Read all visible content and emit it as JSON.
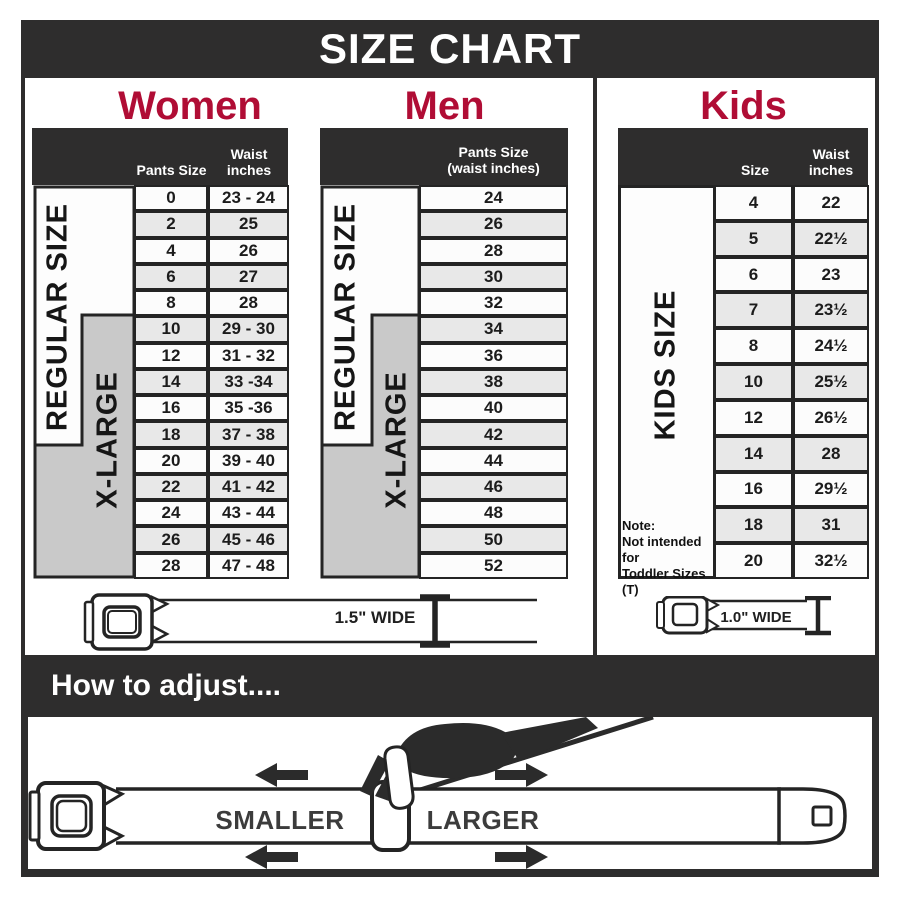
{
  "title": "SIZE CHART",
  "colors": {
    "dark": "#2e2d2d",
    "accent_red": "#b00d35",
    "xlarge_gray": "#c9c9c9",
    "row_alt_gray": "#e8e8e8"
  },
  "women": {
    "heading": "Women",
    "col1_header": "Pants Size",
    "col2_header": "Waist inches",
    "regular_label": "REGULAR SIZE",
    "xlarge_label": "X-LARGE",
    "belt_width_label": "1.5\" WIDE",
    "rows": [
      {
        "size": "0",
        "waist": "23 - 24"
      },
      {
        "size": "2",
        "waist": "25"
      },
      {
        "size": "4",
        "waist": "26"
      },
      {
        "size": "6",
        "waist": "27"
      },
      {
        "size": "8",
        "waist": "28"
      },
      {
        "size": "10",
        "waist": "29 - 30"
      },
      {
        "size": "12",
        "waist": "31 - 32"
      },
      {
        "size": "14",
        "waist": "33 -34"
      },
      {
        "size": "16",
        "waist": "35 -36"
      },
      {
        "size": "18",
        "waist": "37 - 38"
      },
      {
        "size": "20",
        "waist": "39 - 40"
      },
      {
        "size": "22",
        "waist": "41 - 42"
      },
      {
        "size": "24",
        "waist": "43 - 44"
      },
      {
        "size": "26",
        "waist": "45 - 46"
      },
      {
        "size": "28",
        "waist": "47 - 48"
      }
    ]
  },
  "men": {
    "heading": "Men",
    "col_header_line1": "Pants Size",
    "col_header_line2": "(waist inches)",
    "regular_label": "REGULAR SIZE",
    "xlarge_label": "X-LARGE",
    "rows": [
      "24",
      "26",
      "28",
      "30",
      "32",
      "34",
      "36",
      "38",
      "40",
      "42",
      "44",
      "46",
      "48",
      "50",
      "52"
    ]
  },
  "kids": {
    "heading": "Kids",
    "col1_header": "Size",
    "col2_header": "Waist inches",
    "side_label": "KIDS SIZE",
    "note_line1": "Note:",
    "note_line2": "Not intended for",
    "note_line3": "Toddler Sizes (T)",
    "belt_width_label": "1.0\" WIDE",
    "rows": [
      {
        "size": "4",
        "waist": "22"
      },
      {
        "size": "5",
        "waist": "22½"
      },
      {
        "size": "6",
        "waist": "23"
      },
      {
        "size": "7",
        "waist": "23½"
      },
      {
        "size": "8",
        "waist": "24½"
      },
      {
        "size": "10",
        "waist": "25½"
      },
      {
        "size": "12",
        "waist": "26½"
      },
      {
        "size": "14",
        "waist": "28"
      },
      {
        "size": "16",
        "waist": "29½"
      },
      {
        "size": "18",
        "waist": "31"
      },
      {
        "size": "20",
        "waist": "32½"
      }
    ]
  },
  "adjust_section": {
    "heading": "How to adjust....",
    "smaller_label": "SMALLER",
    "larger_label": "LARGER"
  }
}
